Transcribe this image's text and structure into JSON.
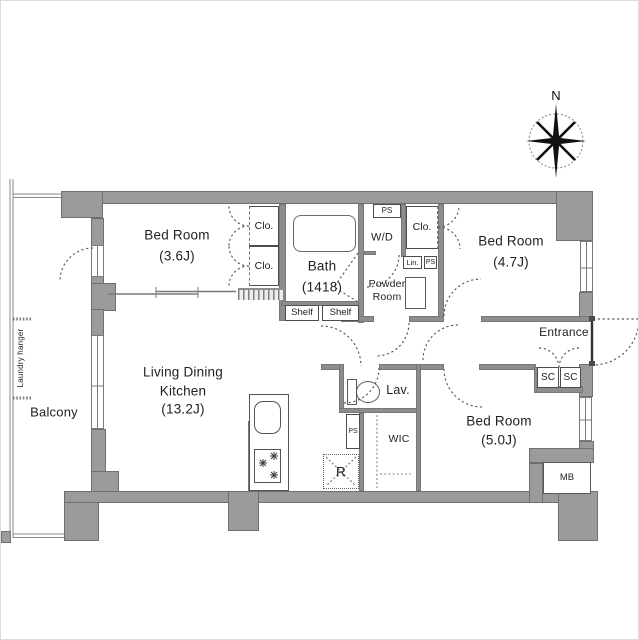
{
  "colors": {
    "wall": "#9b9b9b",
    "wall_edge": "#6f6f6f",
    "inner_wall": "#8d8d8d",
    "line": "#5a5a5a",
    "text": "#1f1f1f",
    "background": "#ffffff"
  },
  "compass": {
    "north_label": "N"
  },
  "rooms": {
    "bedroom_36": {
      "name": "Bed Room",
      "size": "(3.6J)"
    },
    "bath": {
      "name": "Bath",
      "size": "(1418)"
    },
    "powder_room": {
      "name_line1": "Powder",
      "name_line2": "Room"
    },
    "bedroom_47": {
      "name": "Bed Room",
      "size": "(4.7J)"
    },
    "entrance": {
      "name": "Entrance"
    },
    "lav": {
      "name": "Lav."
    },
    "ldk": {
      "name_line1": "Living Dining",
      "name_line2": "Kitchen",
      "size": "(13.2J)"
    },
    "wic": {
      "name": "WIC"
    },
    "bedroom_50": {
      "name": "Bed Room",
      "size": "(5.0J)"
    },
    "balcony": {
      "name": "Balcony"
    },
    "laundry_hanger": {
      "name": "Laundry hanger"
    }
  },
  "fixtures": {
    "closet_36_upper": "Clo.",
    "closet_36_lower": "Clo.",
    "closet_47": "Clo.",
    "ps_top": "PS",
    "washer_dryer": "W/D",
    "linen": "Lin.",
    "ps_powder": "PS",
    "shelf_left": "Shelf",
    "shelf_right": "Shelf",
    "shoe_closet_left": "SC",
    "shoe_closet_right": "SC",
    "ps_lower": "PS",
    "refrigerator": "R",
    "meter_box": "MB"
  }
}
